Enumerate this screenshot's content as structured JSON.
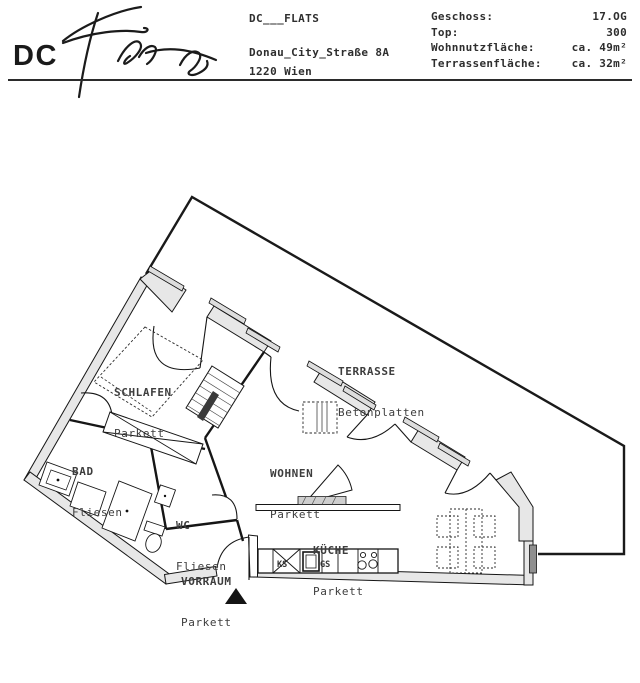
{
  "header": {
    "logo": {
      "monogram": "DC",
      "script": "Flats"
    },
    "project_name": "DC___FLATS",
    "address_line1": "Donau_City_Straße 8A",
    "address_line2": "1220 Wien",
    "facts": [
      {
        "label": "Geschoss:",
        "value": "17.OG"
      },
      {
        "label": "Top:",
        "value": "300"
      },
      {
        "label": "Wohnnutzfläche:",
        "value": "ca. 49m²"
      },
      {
        "label": "Terrassenfläche:",
        "value": "ca. 32m²"
      }
    ]
  },
  "floorplan": {
    "rooms": [
      {
        "name": "SCHLAFEN",
        "floor": "Parkett"
      },
      {
        "name": "BAD",
        "floor": "Fliesen"
      },
      {
        "name": "WC",
        "floor": "Fliesen"
      },
      {
        "name": "VORRAUM",
        "floor": "Parkett"
      },
      {
        "name": "WOHNEN",
        "floor": "Parkett"
      },
      {
        "name": "KÜCHE",
        "floor": "Parkett"
      },
      {
        "name": "TERRASSE",
        "floor": "Betonplatten"
      }
    ],
    "appliance_labels": [
      {
        "label": "KS"
      },
      {
        "label": "GS"
      }
    ]
  },
  "colors": {
    "wall_fill": "#e7e7e7",
    "line": "#1a1a1a",
    "label_text": "#3d3d3d"
  }
}
